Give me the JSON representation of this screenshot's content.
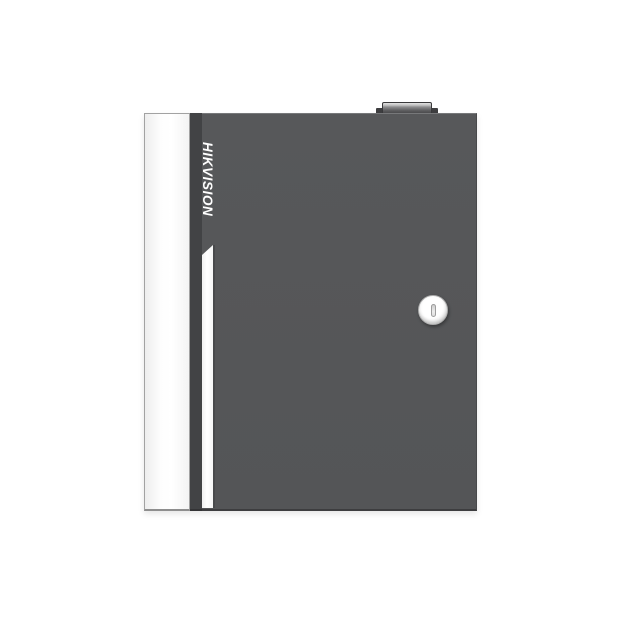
{
  "scene": {
    "type": "product-photo",
    "background_color": "#ffffff"
  },
  "device": {
    "brand": "HIKVISION",
    "parts": {
      "lock": "circular-cam-lock-with-vertical-keyhole",
      "accent_stripe": "vertical-white-stripe-slanted-top",
      "door_edge": "white-left-side-panel",
      "top_knob": "raised-cap-on-top-edge"
    },
    "colors": {
      "background": "#ffffff",
      "body": "#57585a",
      "door_edge_panel": "#f6f6f6",
      "hinge_gap": "#424345",
      "accent_stripe": "#ffffff",
      "logo_text": "#ffffff",
      "lock_face": "#f2f2f2",
      "top_knob_cap": "#bfbfbf"
    }
  }
}
